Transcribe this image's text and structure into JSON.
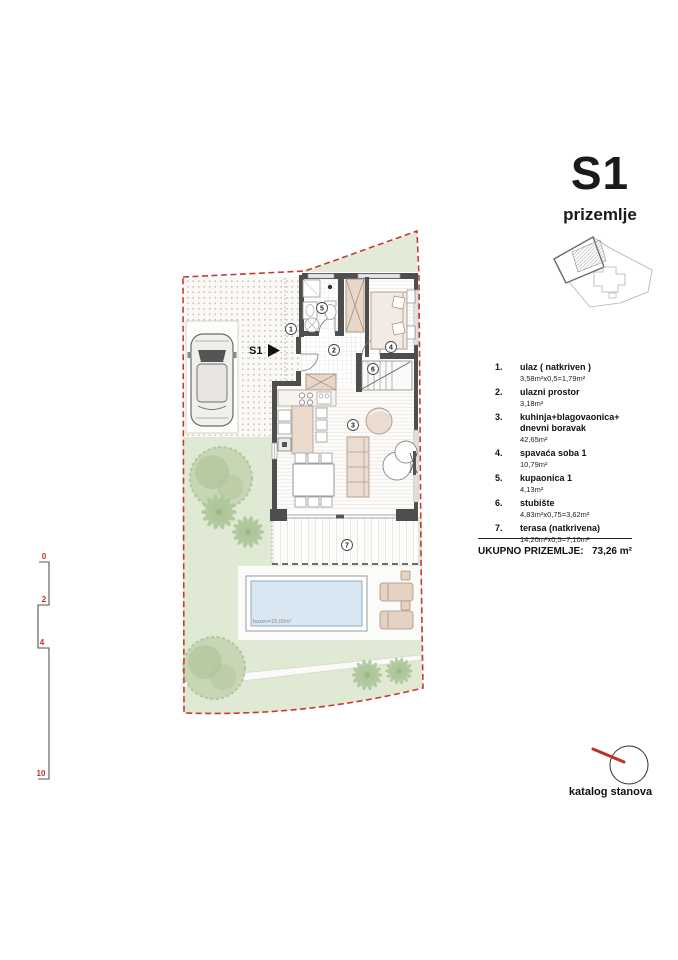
{
  "title": {
    "unit": "S1",
    "floor": "prizemlje"
  },
  "legend": {
    "items": [
      {
        "n": "1.",
        "label": "ulaz ( natkriven )",
        "label2": "",
        "area": "3,58m²x0,5=1,79m²"
      },
      {
        "n": "2.",
        "label": "ulazni prostor",
        "label2": "",
        "area": "3,18m²"
      },
      {
        "n": "3.",
        "label": "kuhinja+blagovaonica+",
        "label2": "dnevni boravak",
        "area": "42,65m²"
      },
      {
        "n": "4.",
        "label": "spavaća soba 1",
        "label2": "",
        "area": "10,79m²"
      },
      {
        "n": "5.",
        "label": "kupaonica 1",
        "label2": "",
        "area": "4,13m²"
      },
      {
        "n": "6.",
        "label": "stubište",
        "label2": "",
        "area": "4,83m²x0,75=3,62m²"
      },
      {
        "n": "7.",
        "label": "terasa (natkrivena)",
        "label2": "",
        "area": "14,20m²x0,5=7,10m²"
      }
    ]
  },
  "total": {
    "label": "UKUPNO PRIZEMLJE:",
    "value": "73,26 m²"
  },
  "plan": {
    "unit_label": "S1",
    "pool_label": "bazen=15,00m²",
    "markers": [
      "1",
      "2",
      "3",
      "4",
      "5",
      "6",
      "7"
    ]
  },
  "scale": {
    "labels": [
      "0",
      "2",
      "4",
      "10"
    ]
  },
  "footer": {
    "katalog": "katalog stanova"
  },
  "colors": {
    "boundary": "#c73a30",
    "lawn": "#dfe9d3",
    "pool": "#d9e7f3",
    "accent_red": "#c03028"
  }
}
